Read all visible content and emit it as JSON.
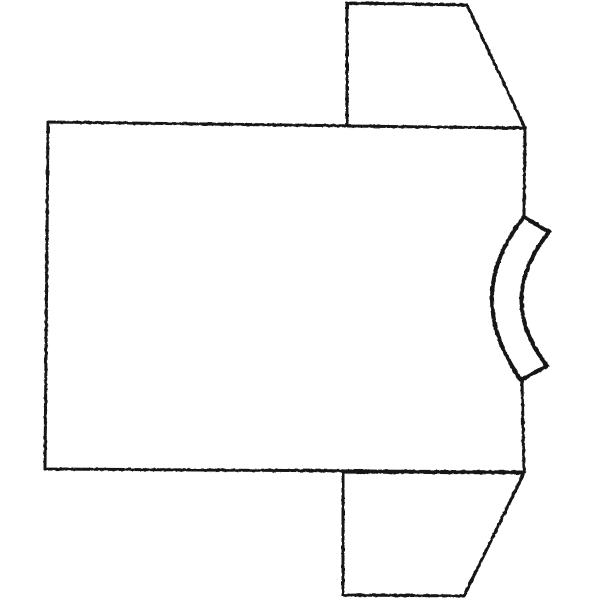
{
  "canvas": {
    "width": 600,
    "height": 600,
    "background": "#ffffff"
  },
  "drawing": {
    "subject": "t-shirt-outline-rotated-sideways-collar-right",
    "stroke_color": "#161616",
    "fill_color": "#ffffff",
    "shapes": [
      {
        "name": "tshirt-body-panel",
        "type": "path",
        "d": "M 525,128 L 48,122 L 45,469 L 524,472 L 522,381 M 524,216 L 525,128",
        "fill": "none",
        "stroke_width": 3
      },
      {
        "name": "tshirt-sleeve-top",
        "type": "path",
        "d": "M 347,126 L 347,3 L 467,5 L 525,128 Z",
        "fill": "#ffffff",
        "stroke_width": 3
      },
      {
        "name": "tshirt-sleeve-bottom",
        "type": "path",
        "d": "M 343,472 L 343,595 L 464,596 L 524,473 Z",
        "fill": "#ffffff",
        "stroke_width": 3
      },
      {
        "name": "tshirt-collar-band",
        "type": "path",
        "d": "M 524,217 L 549,232 Q 495,299 547,366 L 521,380 Q 461.5,295.5 524,217 Z",
        "fill": "#ffffff",
        "stroke_width": 4
      }
    ]
  }
}
